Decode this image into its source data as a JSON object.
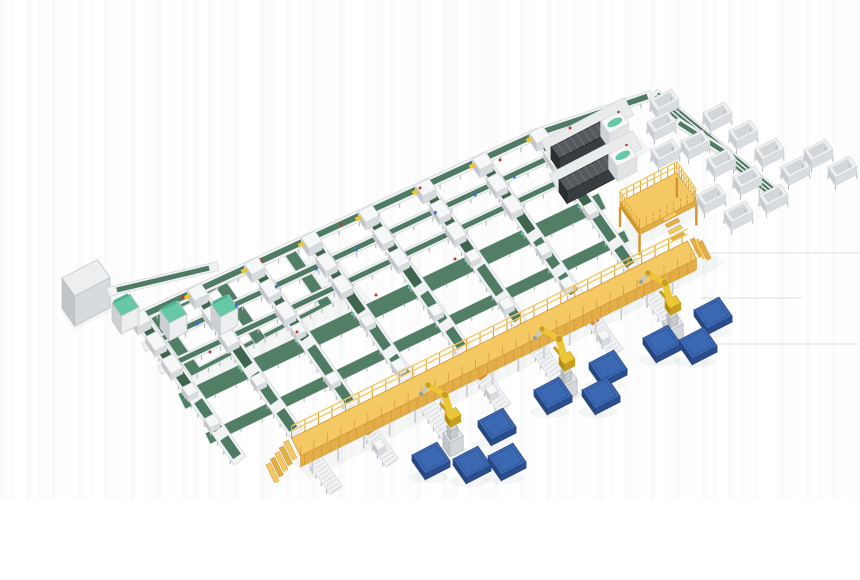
{
  "meta": {
    "title": "3D render of automated conveyor sorting factory with robots, green belt lines, yellow walkway and blue pallets",
    "canvas": {
      "w": 860,
      "h": 580
    },
    "background": "#ffffff"
  },
  "colors": {
    "frame": "#f1f2f4",
    "frameEdge": "#d3d6d9",
    "frameShade": "#e3e5e7",
    "belt": "#4f7a63",
    "beltDark": "#3f654f",
    "beltWide": "#527e66",
    "mint": "#66c8a6",
    "mintDark": "#4db392",
    "yellow": "#f4c963",
    "yellowSide": "#e3ad47",
    "yellowDark": "#d1962f",
    "rail": "#d9a33c",
    "robot": "#ecc636",
    "robotDark": "#c79d22",
    "robotGray": "#c3c7cb",
    "blue": "#3c69b4",
    "blueSide": "#2b4d8a",
    "blueDark": "#274680",
    "dark": "#393c40",
    "darkTop": "#565a5f",
    "darkSide": "#2c2f32",
    "rib": "#72767c",
    "boxTop": "#eceeef",
    "boxFront": "#d8dbdd",
    "boxLeft": "#c2c6c9",
    "leg": "#b4b8bc",
    "roller": "#d6d9dc",
    "shadow": "rgba(80,90,100,0.10)",
    "shadowSoft": "rgba(80,90,100,0.055)",
    "red": "#c0392b",
    "tagBlue": "#3a6fd8",
    "faint": "#dcdfe1"
  },
  "scene": {
    "projection": {
      "u": [
        0.888,
        -0.46
      ],
      "v": [
        0.574,
        0.819
      ]
    },
    "shadows": [
      {
        "pts": [
          [
            150,
            330
          ],
          [
            330,
            248
          ],
          [
            372,
            302
          ],
          [
            205,
            392
          ]
        ]
      },
      {
        "pts": [
          [
            60,
            310
          ],
          [
            112,
            286
          ],
          [
            125,
            306
          ],
          [
            73,
            330
          ]
        ]
      },
      {
        "pts": [
          [
            284,
            452
          ],
          [
            700,
            247
          ],
          [
            726,
            263
          ],
          [
            310,
            480
          ]
        ]
      },
      {
        "pts": [
          [
            612,
            230
          ],
          [
            694,
            190
          ],
          [
            708,
            212
          ],
          [
            628,
            252
          ]
        ]
      },
      {
        "pts": [
          [
            546,
            152
          ],
          [
            616,
            118
          ],
          [
            652,
            150
          ],
          [
            582,
            187
          ]
        ]
      }
    ],
    "faintLines": [
      [
        678,
        253,
        858,
        253
      ],
      [
        700,
        298,
        802,
        298
      ],
      [
        663,
        344,
        858,
        344
      ]
    ],
    "loop": {
      "anchor": [
        150,
        318
      ],
      "a": 160,
      "b": 72,
      "w": 13,
      "midU": 78
    },
    "grayBox": {
      "anchor": [
        62,
        278
      ],
      "a": 40,
      "b": 22,
      "h": 30
    },
    "linkLine": {
      "from": [
        108,
        292
      ],
      "to": [
        218,
        266
      ],
      "w": 9
    },
    "feedLine": {
      "from": [
        135,
        319
      ],
      "to": [
        539,
        133
      ],
      "w": 11
    },
    "topLine": {
      "from": [
        539,
        133
      ],
      "to": [
        652,
        95
      ],
      "w": 10
    },
    "rightLine": {
      "from": [
        653,
        94
      ],
      "to": [
        777,
        196
      ],
      "w": 13,
      "stripes": 3
    },
    "shortLine": {
      "from": [
        676,
        121
      ],
      "to": [
        726,
        153
      ],
      "w": 9
    },
    "lanes": {
      "count": 8,
      "head0": [
        140,
        318
      ],
      "step": [
        57,
        -26.2
      ],
      "endLine": {
        "a": 578,
        "b": -0.488
      },
      "spurLine": 604,
      "spurLen": 46,
      "width": 15,
      "beltW": 9.5,
      "beltSegs": [
        [
          0.05,
          0.14
        ],
        [
          0.2,
          0.3
        ],
        [
          0.36,
          0.52
        ],
        [
          0.58,
          0.78
        ],
        [
          0.84,
          0.97
        ]
      ],
      "spurLanes": [
        1,
        2,
        3,
        4,
        5,
        6,
        7
      ]
    },
    "cross": [
      {
        "t": 0.16,
        "kind": "conveyor",
        "w": 9
      },
      {
        "t": 0.32,
        "kind": "conveyor",
        "w": 9
      },
      {
        "t": 0.54,
        "kind": "belt",
        "w": 17
      },
      {
        "t": 0.8,
        "kind": "belt",
        "w": 12
      }
    ],
    "bridgeTs": [
      0.16,
      0.32
    ],
    "carriages": [
      [
        0,
        0.5
      ],
      [
        0,
        0.72
      ],
      [
        1,
        0.62
      ],
      [
        2,
        0.45
      ],
      [
        2,
        0.8
      ],
      [
        3,
        0.58
      ],
      [
        4,
        0.7
      ],
      [
        5,
        0.5
      ],
      [
        5,
        0.85
      ],
      [
        6,
        0.65
      ],
      [
        7,
        0.55
      ],
      [
        3,
        0.9
      ],
      [
        6,
        0.9
      ]
    ],
    "cabinets": [
      [
        112,
        303
      ],
      [
        160,
        310
      ],
      [
        211,
        304
      ]
    ],
    "machines": [
      [
        551,
        147
      ],
      [
        559,
        180
      ]
    ],
    "platform": {
      "anchor": [
        620,
        202
      ],
      "a": 64,
      "b": 34,
      "legH": 20
    },
    "walkway": {
      "c0": [
        296,
        447
      ],
      "c1": [
        692,
        250
      ],
      "w": 20
    },
    "robots": [
      [
        452,
        446
      ],
      [
        566,
        390
      ],
      [
        672,
        334
      ]
    ],
    "pallets": [
      [
        694,
        310
      ],
      [
        643,
        338
      ],
      [
        679,
        340
      ],
      [
        589,
        363
      ],
      [
        534,
        390
      ],
      [
        582,
        390
      ],
      [
        478,
        421
      ],
      [
        412,
        455
      ],
      [
        453,
        459
      ],
      [
        488,
        456
      ]
    ],
    "bins": [
      [
        650,
        100
      ],
      [
        647,
        122
      ],
      [
        651,
        150
      ],
      [
        703,
        113
      ],
      [
        729,
        131
      ],
      [
        755,
        149
      ],
      [
        781,
        167
      ],
      [
        681,
        141
      ],
      [
        707,
        159
      ],
      [
        733,
        177
      ],
      [
        759,
        195
      ],
      [
        804,
        150
      ],
      [
        828,
        167
      ],
      [
        724,
        212
      ],
      [
        697,
        195
      ]
    ],
    "redDots": [
      [
        183,
        297
      ],
      [
        262,
        261
      ],
      [
        341,
        224
      ],
      [
        420,
        188
      ],
      [
        297,
        332
      ],
      [
        376,
        295
      ],
      [
        455,
        259
      ],
      [
        210,
        352
      ],
      [
        500,
        160
      ],
      [
        570,
        128
      ]
    ],
    "blueTags": [
      [
        196,
        322
      ],
      [
        275,
        285
      ],
      [
        355,
        248
      ],
      [
        434,
        211
      ],
      [
        474,
        193
      ],
      [
        315,
        267
      ],
      [
        235,
        304
      ],
      [
        513,
        175
      ]
    ]
  }
}
